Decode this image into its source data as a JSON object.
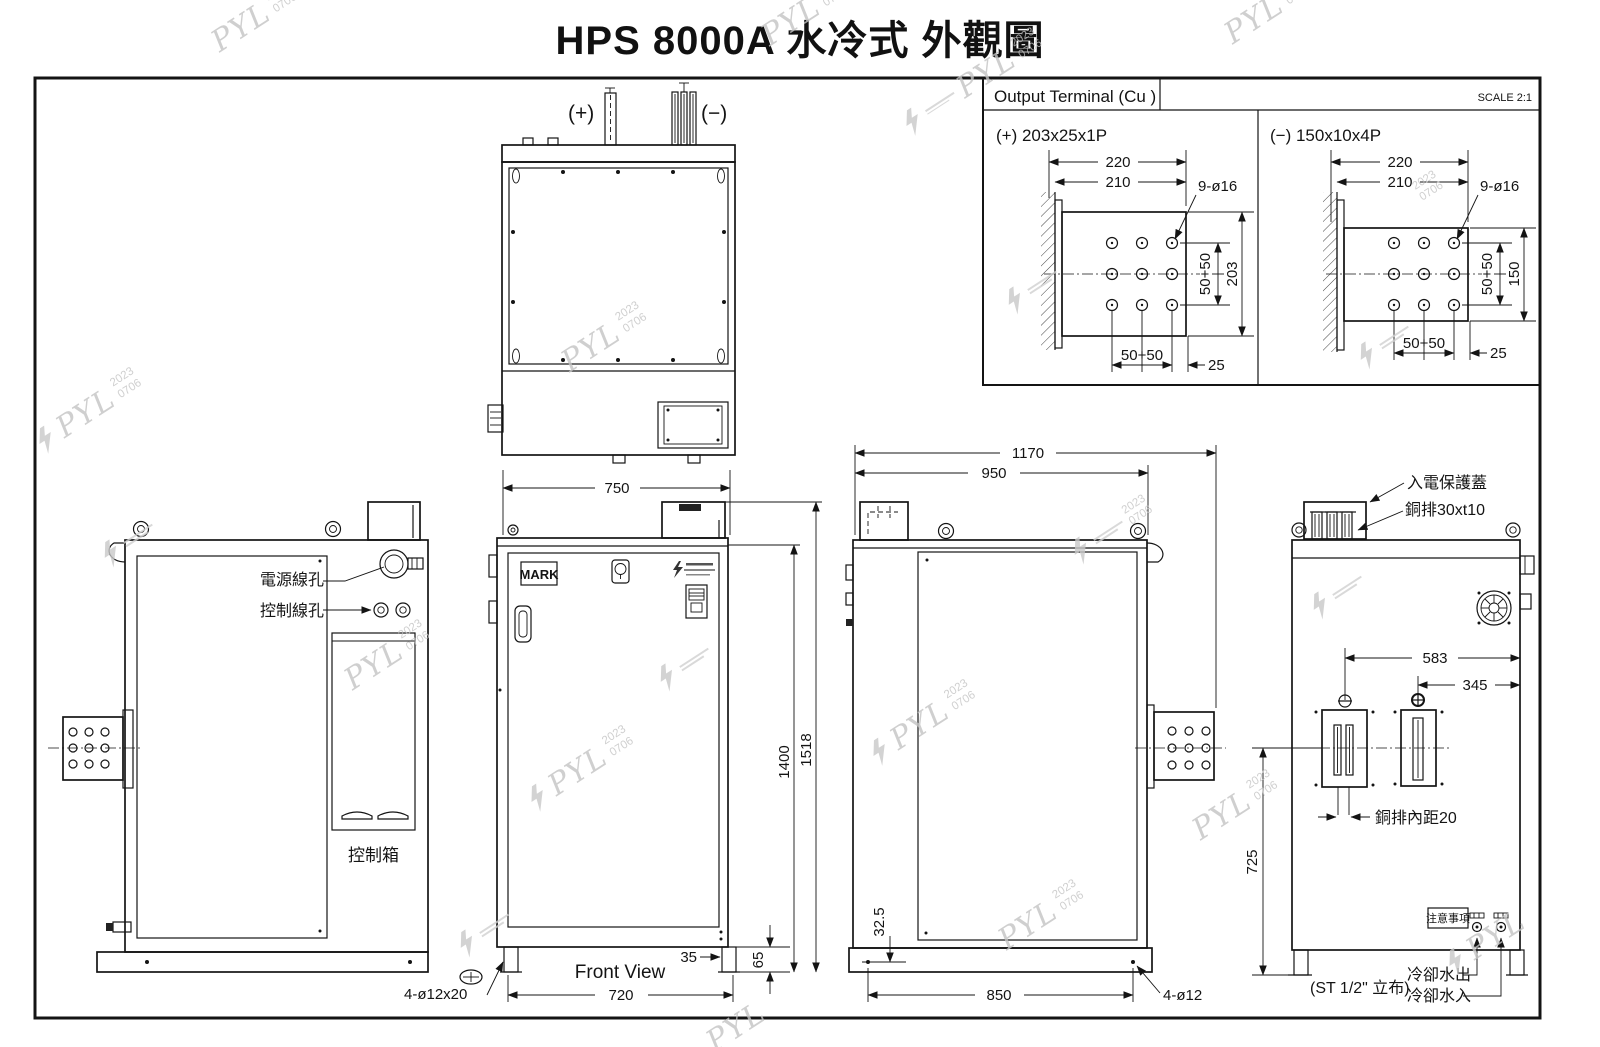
{
  "title": "HPS 8000A 水冷式 外觀圖",
  "colors": {
    "line": "#141414",
    "watermark": "#c4c4c4",
    "background": "#ffffff"
  },
  "watermark": {
    "name": "PYL",
    "year": "2023",
    "code": "0706"
  },
  "output_terminal": {
    "title": "Output Terminal (Cu )",
    "scale": "SCALE 2:1",
    "positive": {
      "label": "(+) 203x25x1P",
      "dim_outer": "220",
      "dim_inner": "210",
      "hole_callout": "9-ø16",
      "side_span": "50+50",
      "side_total": "203",
      "bottom_span": "50+50",
      "bottom_edge": "25"
    },
    "negative": {
      "label": "(−) 150x10x4P",
      "dim_outer": "220",
      "dim_inner": "210",
      "hole_callout": "9-ø16",
      "side_span": "50+50",
      "side_total": "150",
      "bottom_span": "50+50",
      "bottom_edge": "25"
    }
  },
  "top_view": {
    "positive": "(+)",
    "negative": "(−)"
  },
  "left_view": {
    "power_hole": "電源線孔",
    "control_hole": "控制線孔",
    "control_box": "控制箱"
  },
  "front_view": {
    "mark": "MARK",
    "width": "750",
    "body_height": "1400",
    "total_height": "1518",
    "foot_offset": "35",
    "base_height": "65",
    "foot_span": "720",
    "slot_callout": "4-ø12x20",
    "caption": "Front View"
  },
  "side_view": {
    "depth_total": "1170",
    "depth_body": "950",
    "hole_height": "32.5",
    "foot_span": "850",
    "hole_callout": "4-ø12"
  },
  "rear_view": {
    "cover": "入電保護蓋",
    "busbar": "銅排30xt10",
    "dim_a": "583",
    "dim_b": "345",
    "dim_height": "725",
    "busbar_gap": "銅排內距20",
    "notice": "注意事項",
    "pipe": "(ST 1/2\" 立布)",
    "water_out": "冷卻水出",
    "water_in": "冷卻水入"
  }
}
